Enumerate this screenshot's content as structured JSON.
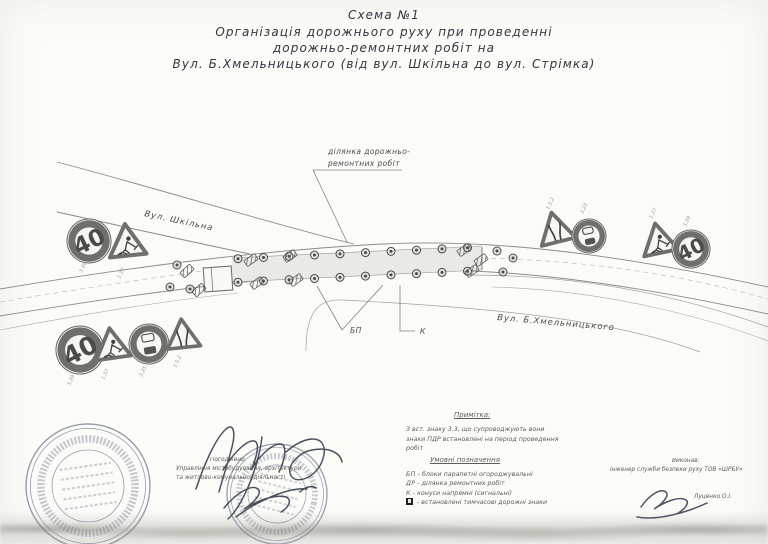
{
  "title": {
    "lines": [
      "Схема №1",
      "Організація дорожнього руху при проведенні",
      "дорожньо-ремонтних робіт на",
      "Вул. Б.Хмельницького (від вул. Шкільна до вул. Стрімка)"
    ]
  },
  "diagram": {
    "work_zone_label_line1": "ділянка дорожньо-",
    "work_zone_label_line2": "ремонтних робіт",
    "street_school": "Вул. Шкільна",
    "street_main": "Вул. Б.Хмельницького",
    "marker_bp": "БП",
    "marker_k": "К",
    "speed_value": "40",
    "sign_codes": {
      "speed_limit": "3.29",
      "road_works": "1.37",
      "no_overtaking": "3.25",
      "road_narrows": "1.5.2"
    }
  },
  "note": {
    "heading": "Примітка:",
    "lines": [
      "З вст. знаку 3.3, що супроводжують вони",
      "знаки ПДР встановлені на період проведення",
      "робіт"
    ]
  },
  "legend": {
    "heading": "Умовні позначення",
    "items": [
      {
        "code": "БП",
        "text": "- блоки парапетні огороджувальні"
      },
      {
        "code": "ДР",
        "text": "- ділянка ремонтних робіт"
      },
      {
        "code": "К",
        "text": "- конуси напрямні (сигнальні)"
      },
      {
        "code": "",
        "text": "- встановлені тимчасові дорожні знаки"
      }
    ]
  },
  "approvals": {
    "center": {
      "line1": "Погоджено",
      "line2": "Управління містобудування, архітектури",
      "line3": "та житлово-комунальної діяльності"
    },
    "right": {
      "line1": "Виконав:",
      "line2": "інженер служби безпеки руху ТОВ «ШРБУ»",
      "name": "Луценко О.І."
    }
  },
  "colors": {
    "paper": "#fbfbf8",
    "ink": "#32383e",
    "road_line": "#8a8a86",
    "zone_fill": "#e9e9e5",
    "stamp_ink": "#55617a"
  }
}
